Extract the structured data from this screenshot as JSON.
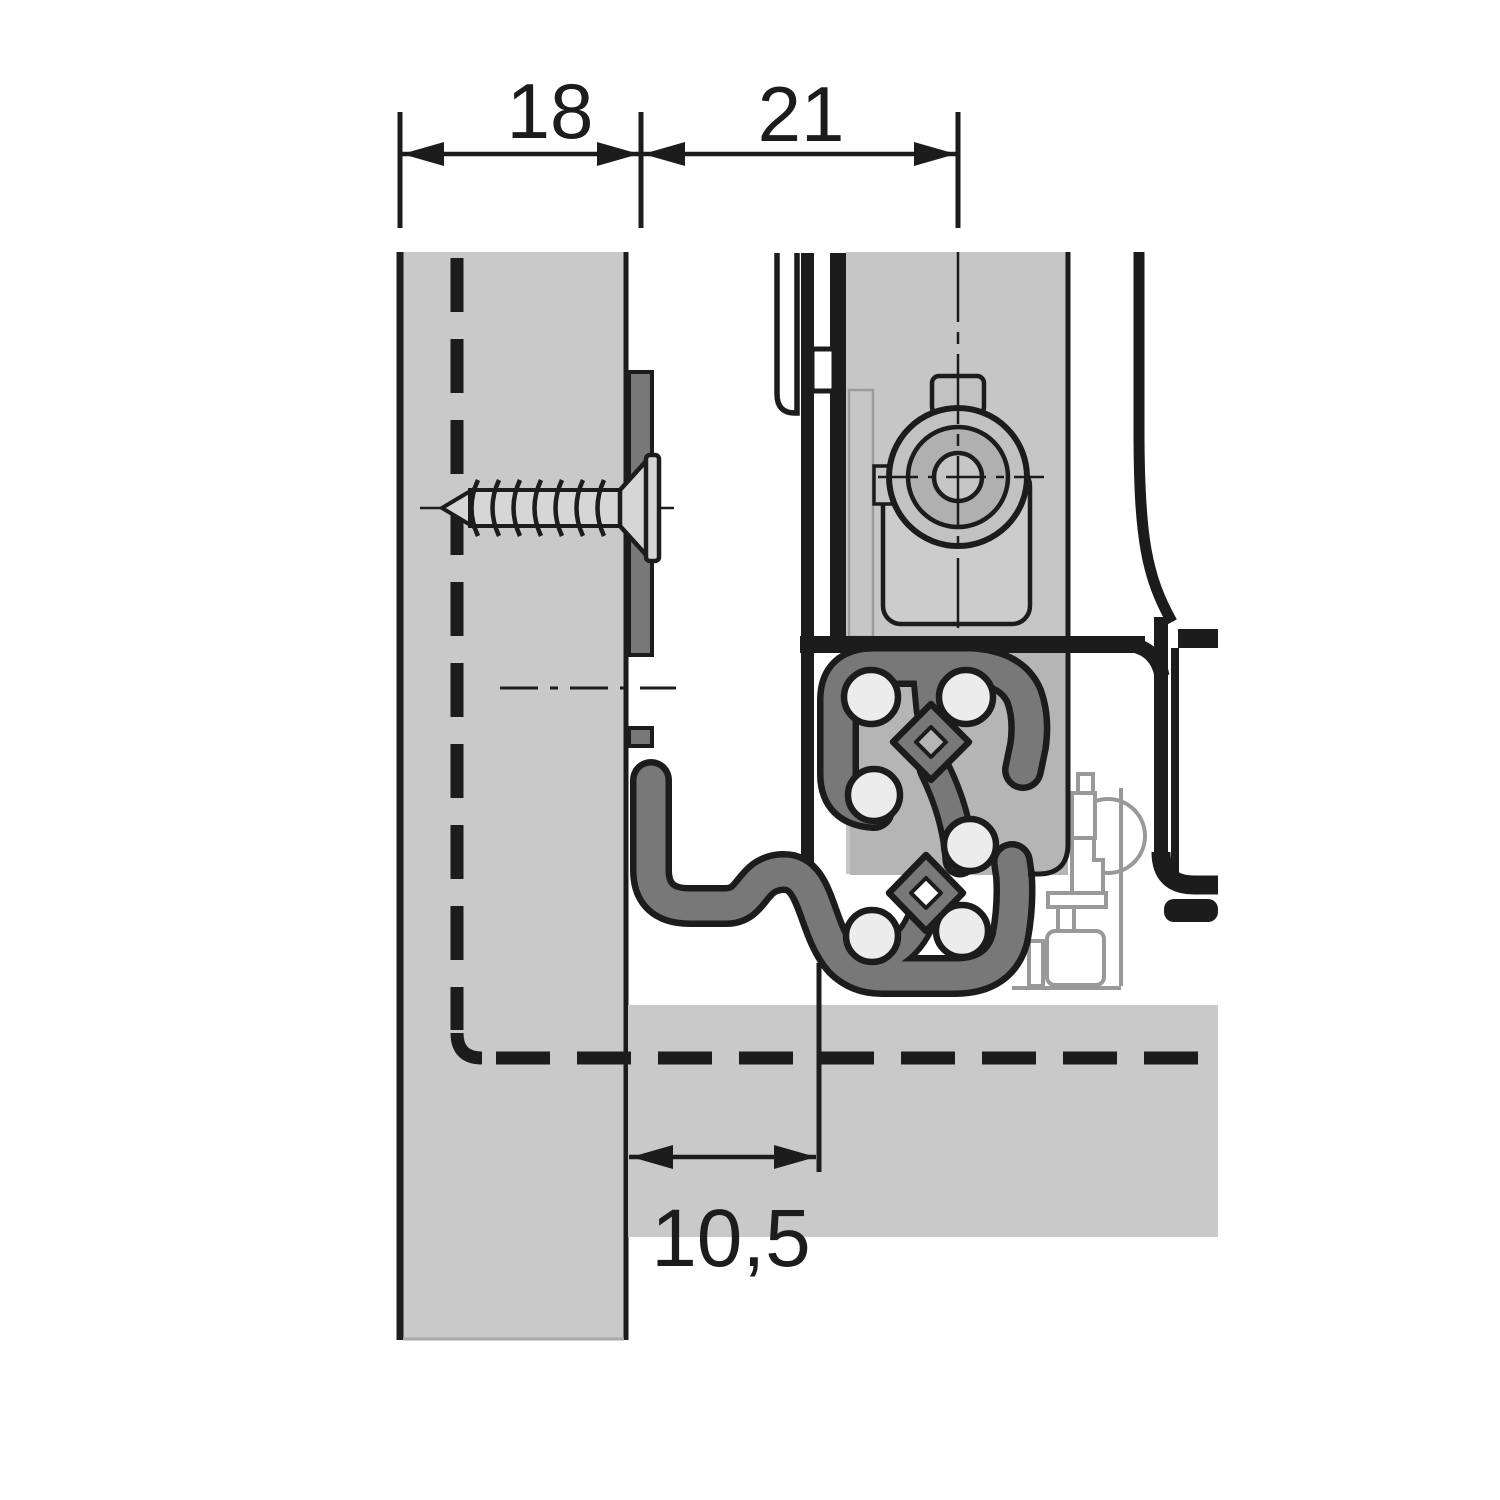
{
  "drawing": {
    "type": "technical-cross-section",
    "dimensions": {
      "top_left": {
        "label": "18",
        "value": 18
      },
      "top_right": {
        "label": "21",
        "value": 21
      },
      "bottom": {
        "label": "10,5",
        "value": 10.5
      }
    },
    "colors": {
      "background": "#ffffff",
      "outline_black": "#1c1c1c",
      "panel_gray": "#c9c9c9",
      "drawer_gray": "#c6c6c6",
      "housing_gray": "#cccccc",
      "wheel_ring_gray": "#b0b0b0",
      "runner_rail_gray": "#787878",
      "backdrop_gray": "#b5b5b5",
      "ball_gray": "#ececec",
      "screw_gray": "#d6d6d6",
      "hidden_part_gray": "#999999"
    }
  }
}
